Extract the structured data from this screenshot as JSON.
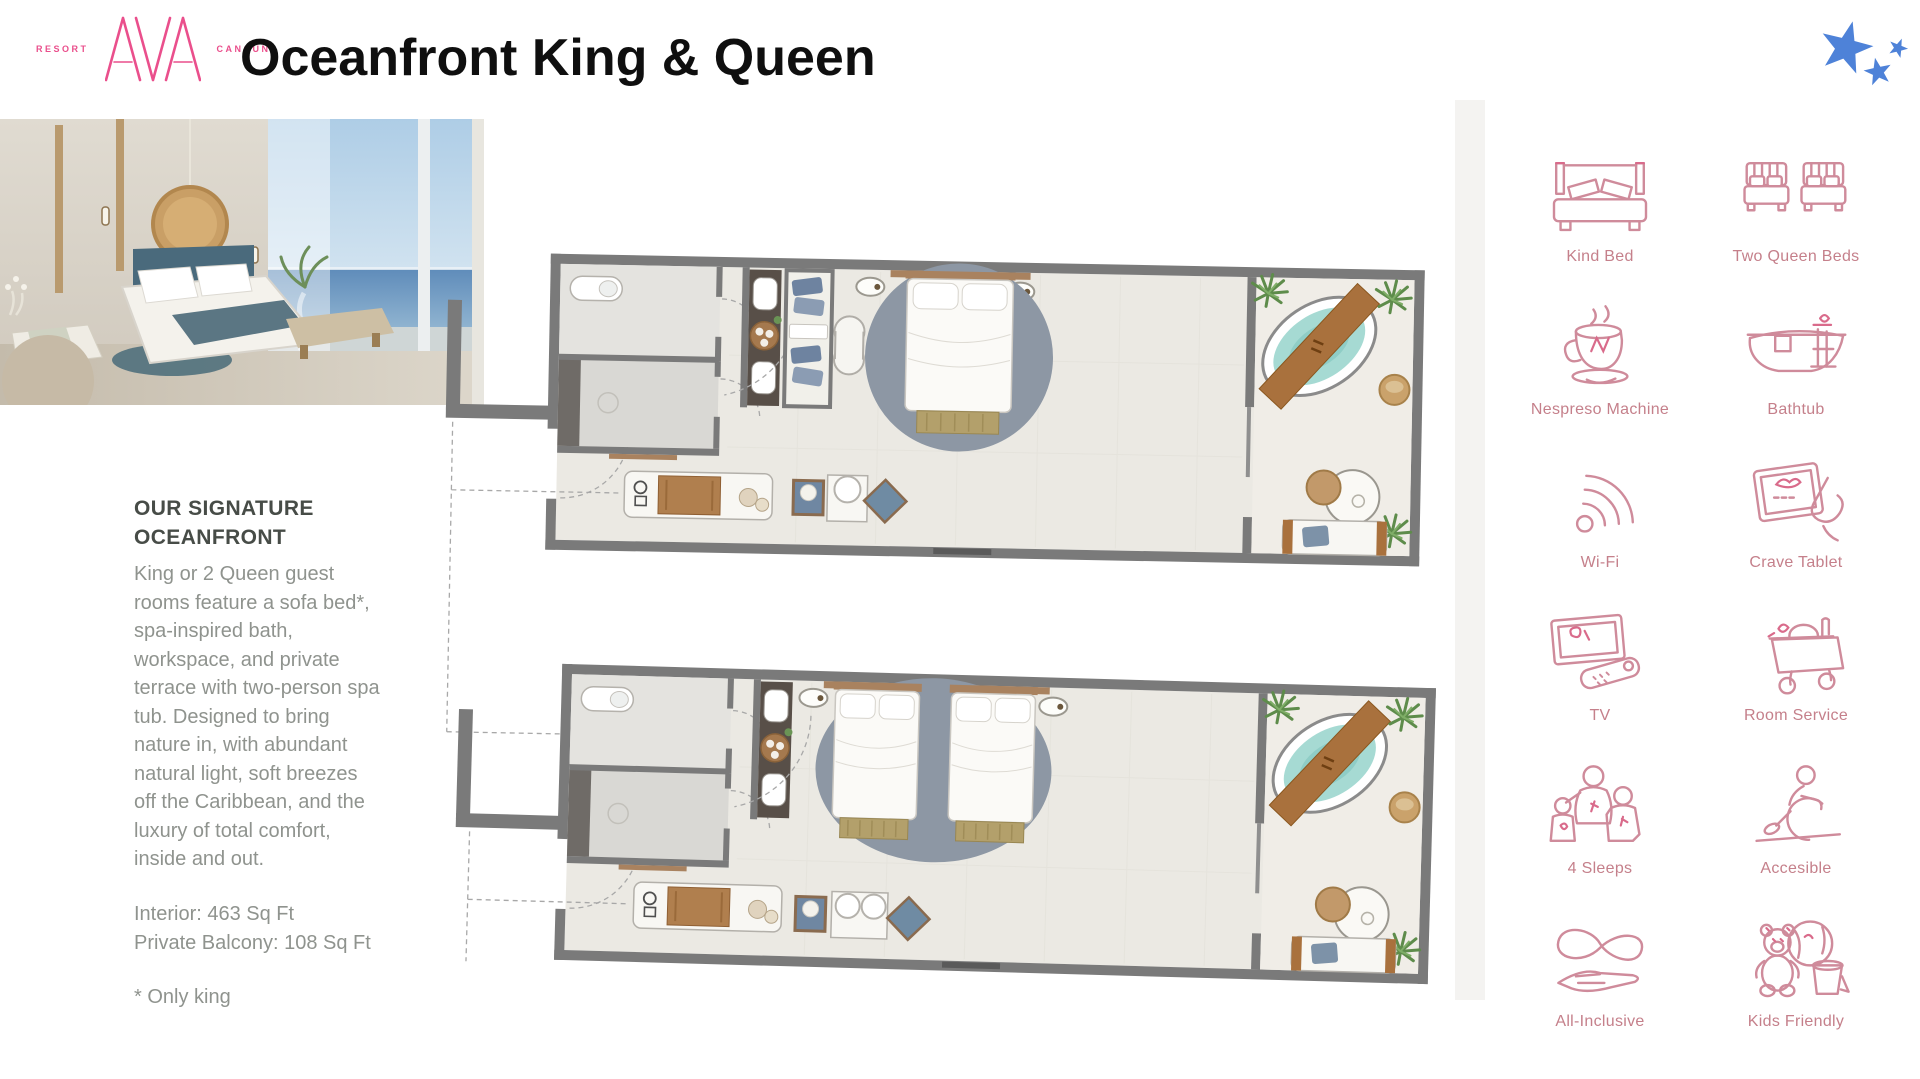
{
  "header": {
    "logo": {
      "left": "RESORT",
      "brand": "AVA",
      "right": "CANCUN"
    },
    "title": "Oceanfront King & Queen"
  },
  "sidebar": {
    "heading_line1": "OUR SIGNATURE",
    "heading_line2": "OCEANFRONT",
    "body_lines": [
      "King or 2 Queen guest",
      "rooms feature a sofa bed*,",
      "spa-inspired bath,",
      "workspace, and private",
      "terrace with two-person spa",
      "tub. Designed to bring",
      "nature in, with abundant",
      "natural light, soft breezes",
      "off the Caribbean, and the",
      "luxury of total comfort,",
      "inside and out."
    ],
    "specs": [
      "Interior: 463 Sq Ft",
      "Private Balcony: 108 Sq Ft"
    ],
    "footnote": "* Only king"
  },
  "amenities": [
    {
      "icon": "king-bed-icon",
      "label": "Kind Bed"
    },
    {
      "icon": "two-queen-beds-icon",
      "label": "Two Queen Beds"
    },
    {
      "icon": "nespresso-icon",
      "label": "Nespreso Machine"
    },
    {
      "icon": "bathtub-icon",
      "label": "Bathtub"
    },
    {
      "icon": "wifi-icon",
      "label": "Wi-Fi"
    },
    {
      "icon": "crave-tablet-icon",
      "label": "Crave Tablet"
    },
    {
      "icon": "tv-icon",
      "label": "TV"
    },
    {
      "icon": "room-service-icon",
      "label": "Room Service"
    },
    {
      "icon": "four-sleeps-icon",
      "label": "4 Sleeps"
    },
    {
      "icon": "accessible-icon",
      "label": "Accesible"
    },
    {
      "icon": "all-inclusive-icon",
      "label": "All-Inclusive"
    },
    {
      "icon": "kids-friendly-icon",
      "label": "Kids Friendly"
    }
  ],
  "floorplans": [
    {
      "name": "king-room-plan"
    },
    {
      "name": "two-queen-room-plan"
    }
  ],
  "colors": {
    "brand_pink": "#ea4f8c",
    "amenity_rose": "#cf8b9b",
    "starfish_blue": "#4e82d8",
    "wall_gray": "#7a7a7a",
    "spa_teal": "#a6dad3"
  }
}
